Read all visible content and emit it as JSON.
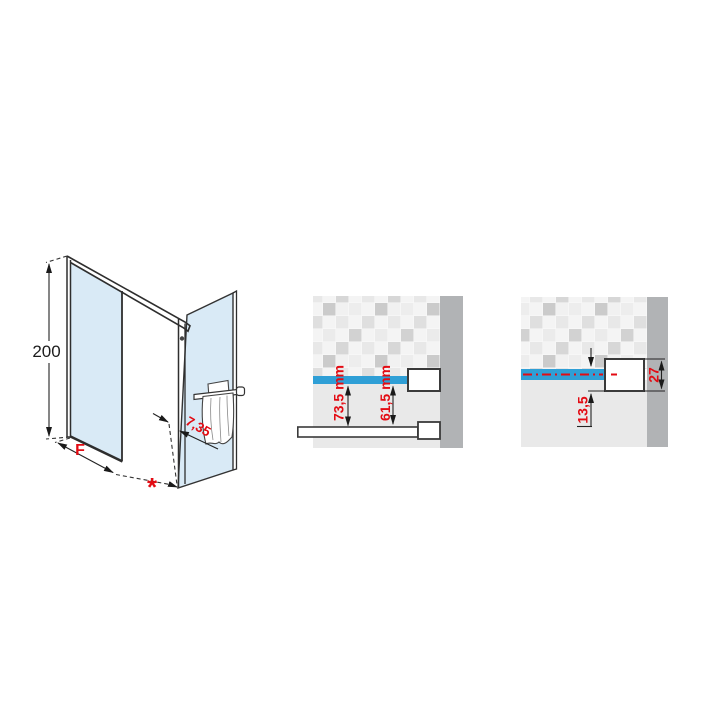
{
  "title": "shower-enclosure-technical-drawing",
  "colors": {
    "glass": "#d9eaf6",
    "blue": "#2f9fd6",
    "red": "#e30b13",
    "wall": "#b1b3b5",
    "plaster": "#e9e9e9"
  },
  "isometric": {
    "height_dim": "200",
    "width_dim": "F",
    "asterisk": "*",
    "corner_offset_dim": "7,35"
  },
  "detail_left": {
    "dim_outer": "73,5 mm",
    "dim_inner": "61,5 mm"
  },
  "detail_right": {
    "dim_offset": "13,5",
    "dim_profile": "27"
  }
}
